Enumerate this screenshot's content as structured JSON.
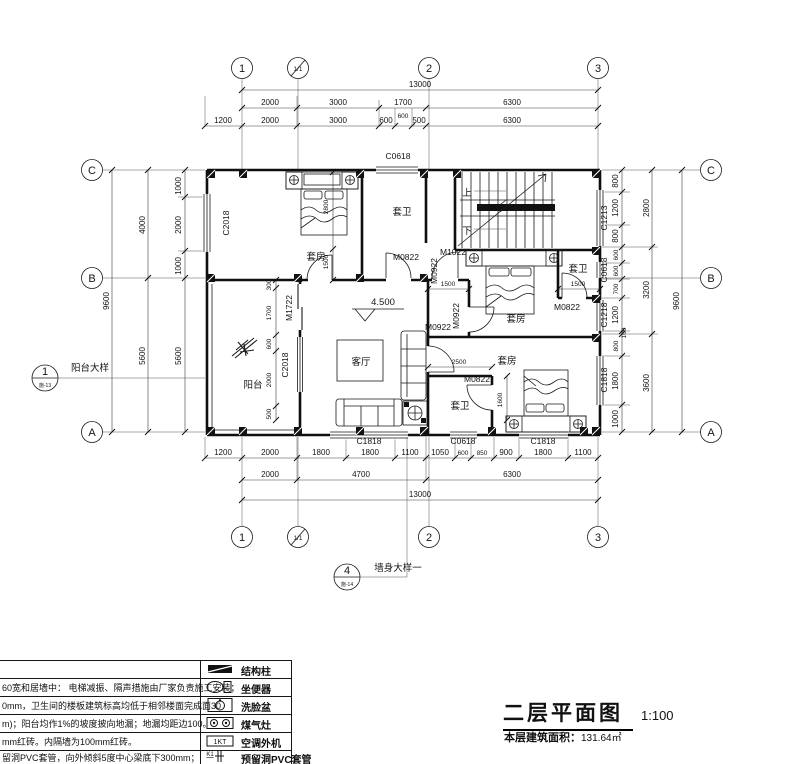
{
  "doc": {
    "title": "二层平面图",
    "scale": "1:100",
    "area_label": "本层建筑面积：",
    "area_value": "131.64㎡"
  },
  "axes": {
    "h": [
      "1",
      "1/1",
      "2",
      "3"
    ],
    "v": [
      "C",
      "B",
      "A"
    ]
  },
  "callouts": {
    "balcony": {
      "num": "1",
      "sheet": "施-13",
      "label": "阳台大样"
    },
    "wall": {
      "num": "4",
      "sheet": "施-14",
      "label": "墙身大样一"
    }
  },
  "dims": {
    "top1": "13000",
    "top2": [
      "2000",
      "3000",
      "1700",
      "6300"
    ],
    "top_float": "600",
    "top3": [
      "1200",
      "2000",
      "3000",
      "600",
      "500",
      "6300"
    ],
    "bottom1": [
      "1200",
      "2000",
      "1800",
      "1800",
      "1100",
      "1050",
      "600",
      "850",
      "900",
      "1800",
      "1100"
    ],
    "bottom2": [
      "2000",
      "4700",
      "6300"
    ],
    "bottom3": "13000",
    "left1": [
      "1000",
      "2000",
      "1000",
      "5600"
    ],
    "left2": [
      "4000",
      "5600"
    ],
    "left3": "9600",
    "right1": [
      "800",
      "1200",
      "800",
      "600",
      "600",
      "700",
      "1200",
      "100",
      "800",
      "1800",
      "1000"
    ],
    "right2": [
      "2800",
      "3200",
      "3600"
    ],
    "right3": "9600",
    "interior": [
      "2800",
      "1500",
      "1500",
      "1500",
      "2500",
      "1600"
    ],
    "balcony_col": [
      "300",
      "1700",
      "600",
      "2000",
      "500"
    ]
  },
  "windows": {
    "left": "C2018",
    "top": "C0618",
    "right": [
      "C1213",
      "C0618",
      "C1218",
      "C1818"
    ],
    "bottom": [
      "C1818",
      "C0618",
      "C1818"
    ],
    "balcony": "C2018"
  },
  "doors": {
    "m1722": "M1722",
    "m0822a": "M0822",
    "m1022": "M1022",
    "m0922a": "M0922",
    "m0922b": "M0922",
    "m0922c": "M0922",
    "m0822b": "M0822",
    "m0822c": "M0822"
  },
  "rooms": {
    "bed1": "套房",
    "bath1": "套卫",
    "bed2": "套房",
    "bath2": "套卫",
    "bed3": "套房",
    "bath3": "套卫",
    "living": "客厅",
    "balcony": "阳台",
    "stair_up": "上",
    "stair_down": "下",
    "elevation": "4.500"
  },
  "legend": {
    "rows": [
      {
        "label": "结构柱"
      },
      {
        "label": "坐便器"
      },
      {
        "label": "洗脸盆"
      },
      {
        "label": "煤气灶"
      },
      {
        "label": "空调外机"
      },
      {
        "label": "预留洞PVC套管"
      }
    ],
    "ac": "1KT",
    "pvc": "K1"
  },
  "notes": [
    "60宽和居墙中： 电梯减振、隔声措施由厂家负责施工安装；",
    "0mm，卫生间的楼板建筑标高均低于相邻楼面完成面30",
    "m)；阳台均作1%的坡度披向地漏；地漏均距边100。",
    "mm红砖。内隔墙为100mm红砖。",
    "留洞PVC套管，向外倾斜5度中心梁底下300mm；"
  ]
}
